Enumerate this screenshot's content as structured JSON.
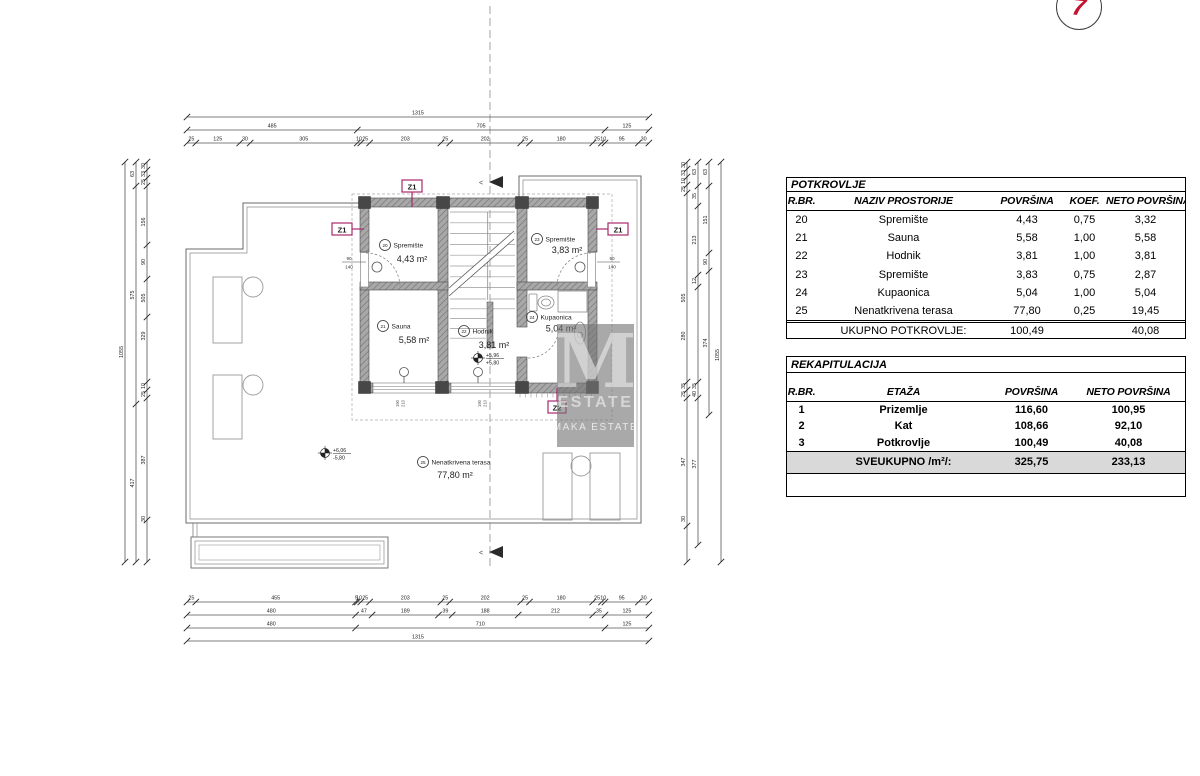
{
  "marker": {
    "number": "7"
  },
  "watermark": {
    "letter": "M",
    "line1": "ESTATE",
    "line2": "MAKA ESTATE"
  },
  "plan": {
    "rooms": [
      {
        "num": "20",
        "name": "Spremište",
        "area": "4,43 m²"
      },
      {
        "num": "21",
        "name": "Sauna",
        "area": "5,58 m²"
      },
      {
        "num": "22",
        "name": "Hodnik",
        "area": "3,81 m²"
      },
      {
        "num": "23",
        "name": "Spremište",
        "area": "3,83 m²"
      },
      {
        "num": "24",
        "name": "Kupaonica",
        "area": "5,04 m²"
      },
      {
        "num": "25",
        "name": "Nenatkrivena terasa",
        "area": "77,80 m²"
      }
    ],
    "section_labels": {
      "z1": "Z1",
      "z2": "Z2",
      "color": "#a92a6c"
    },
    "section_mark": "<",
    "elevations": [
      {
        "top": "+6,06",
        "bottom": "-5,80"
      },
      {
        "top": "+5,96",
        "bottom": "+5,80"
      }
    ],
    "door_dims": [
      {
        "w": "90",
        "h": "140"
      },
      {
        "w": "90",
        "h": "140"
      }
    ],
    "window_dims": [
      {
        "a": "190",
        "b": "210"
      },
      {
        "a": "190",
        "b": "210"
      }
    ],
    "dims": {
      "top": [
        [
          "1315"
        ],
        [
          "485",
          "705",
          "125"
        ],
        [
          "25",
          "125",
          "30",
          "305",
          "10",
          "25",
          "203",
          "25",
          "202",
          "25",
          "180",
          "25",
          "10",
          "95",
          "30"
        ]
      ],
      "bottom": [
        [
          "25",
          "455",
          "5",
          "10",
          "25",
          "203",
          "25",
          "202",
          "25",
          "180",
          "25",
          "10",
          "95",
          "30"
        ],
        [
          "480",
          "47",
          "189",
          "39",
          "188",
          "212",
          "35",
          "125"
        ],
        [
          "480",
          "710",
          "125"
        ],
        [
          "1315"
        ]
      ],
      "left": [
        [
          "1055"
        ],
        [
          "63",
          "575",
          "417"
        ],
        [
          "30",
          "33",
          "25",
          "156",
          "90",
          "505",
          "329",
          "10",
          "25",
          "387",
          "30"
        ]
      ],
      "right": [
        [
          "30",
          "33",
          "10",
          "25",
          "505",
          "280",
          "35",
          "25",
          "347",
          "30"
        ],
        [
          "63",
          "35",
          "213",
          "12",
          "35",
          "40",
          "377"
        ],
        [
          "63",
          "151",
          "90",
          "374"
        ],
        [
          "1055"
        ]
      ]
    }
  },
  "tables": {
    "potkrovlje": {
      "title": "POTKROVLJE",
      "columns": [
        "R.BR.",
        "NAZIV PROSTORIJE",
        "POVRŠINA",
        "KOEF.",
        "NETO POVRŠINA"
      ],
      "rows": [
        [
          "20",
          "Spremište",
          "4,43",
          "0,75",
          "3,32"
        ],
        [
          "21",
          "Sauna",
          "5,58",
          "1,00",
          "5,58"
        ],
        [
          "22",
          "Hodnik",
          "3,81",
          "1,00",
          "3,81"
        ],
        [
          "23",
          "Spremište",
          "3,83",
          "0,75",
          "2,87"
        ],
        [
          "24",
          "Kupaonica",
          "5,04",
          "1,00",
          "5,04"
        ],
        [
          "25",
          "Nenatkrivena terasa",
          "77,80",
          "0,25",
          "19,45"
        ]
      ],
      "total": [
        "",
        "UKUPNO POTKROVLJE:",
        "100,49",
        "",
        "40,08"
      ]
    },
    "rekapitulacija": {
      "title": "REKAPITULACIJA",
      "columns": [
        "R.BR.",
        "ETAŽA",
        "POVRŠINA",
        "NETO POVRŠINA"
      ],
      "rows": [
        [
          "1",
          "Prizemlje",
          "116,60",
          "100,95"
        ],
        [
          "2",
          "Kat",
          "108,66",
          "92,10"
        ],
        [
          "3",
          "Potkrovlje",
          "100,49",
          "40,08"
        ]
      ],
      "total": [
        "",
        "SVEUKUPNO /m²/:",
        "325,75",
        "233,13"
      ]
    }
  }
}
